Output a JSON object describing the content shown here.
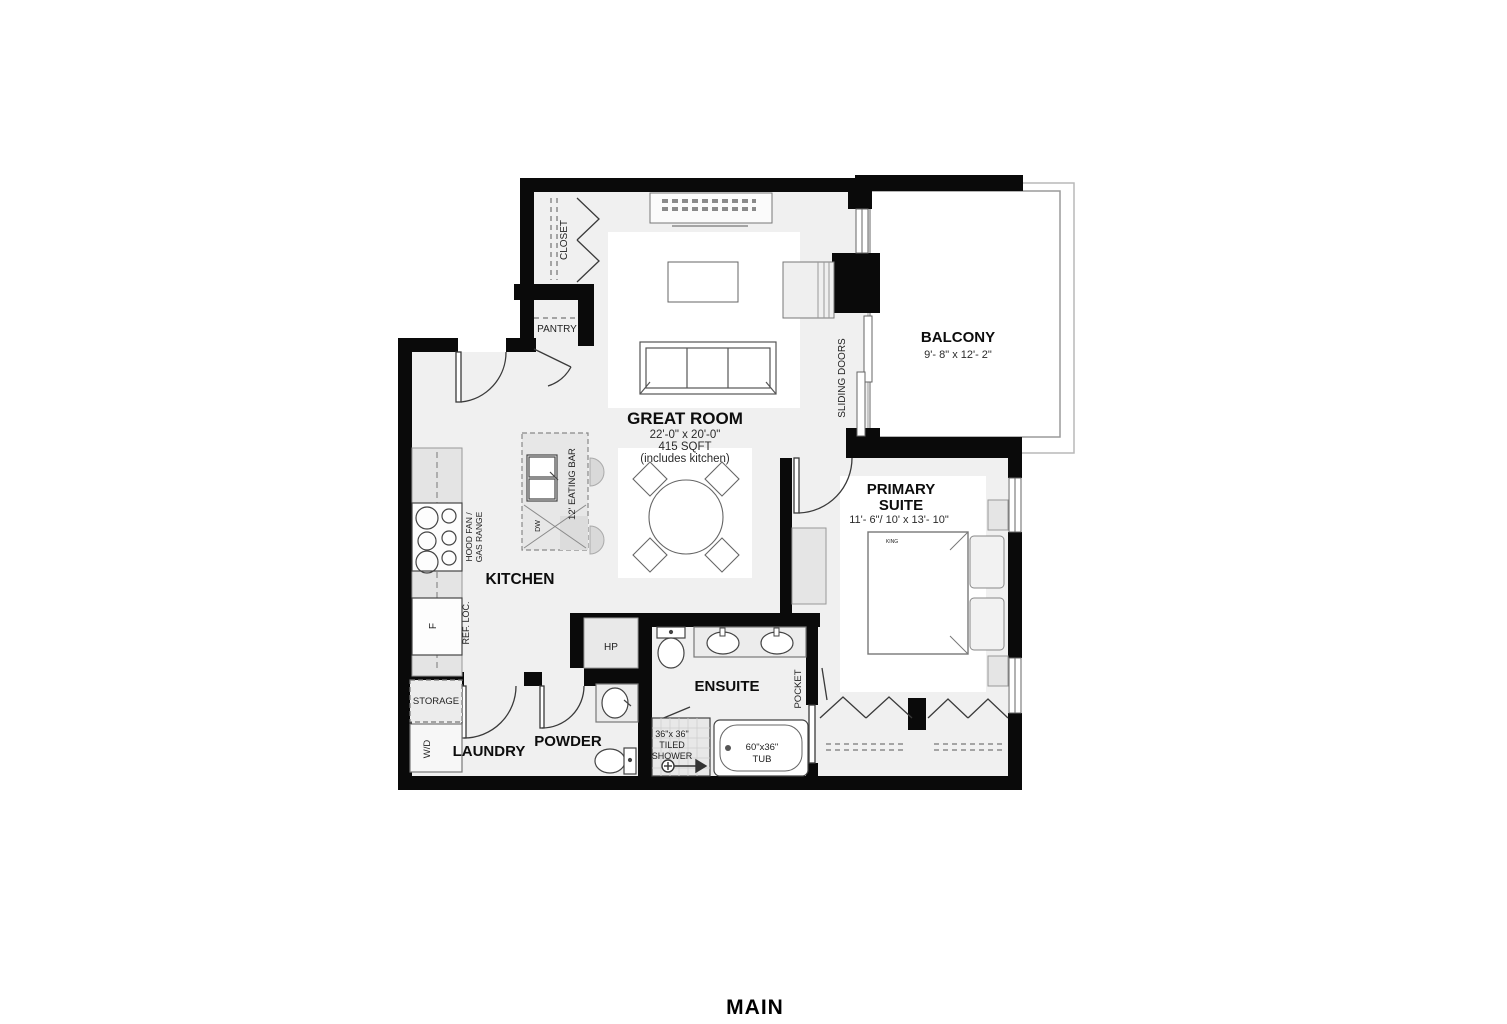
{
  "page": {
    "bottom_title": "MAIN"
  },
  "rooms": {
    "closet": {
      "label": "CLOSET"
    },
    "pantry": {
      "label": "PANTRY"
    },
    "great_room": {
      "label": "GREAT ROOM",
      "dimensions": "22'-0\" x 20'-0\"",
      "area": "415 SQFT",
      "note": "(includes kitchen)"
    },
    "balcony": {
      "label": "BALCONY",
      "dimensions": "9'- 8\" x 12'- 2\""
    },
    "primary_suite": {
      "label_line1": "PRIMARY",
      "label_line2": "SUITE",
      "dimensions": "11'- 6\"/ 10' x 13'- 10\""
    },
    "kitchen": {
      "label": "KITCHEN"
    },
    "ensuite": {
      "label": "ENSUITE"
    },
    "laundry": {
      "label": "LAUNDRY"
    },
    "powder": {
      "label": "POWDER"
    }
  },
  "fixtures": {
    "sliding_doors": "SLIDING DOORS",
    "pocket_door": "POCKET",
    "eating_bar": "12' EATING BAR",
    "dishwasher": "DW",
    "hood_fan_line1": "HOOD FAN /",
    "hood_fan_line2": "GAS RANGE",
    "fridge_location": "REF. LOC.",
    "fridge": "F",
    "heat_pump": "HP",
    "storage": "STORAGE",
    "washer_dryer": "W/D",
    "shower_size": "36\"x 36\"",
    "shower_line2": "TILED",
    "shower_line3": "SHOWER",
    "tub_size": "60\"x36\"",
    "tub": "TUB",
    "bed_size": "KING"
  }
}
